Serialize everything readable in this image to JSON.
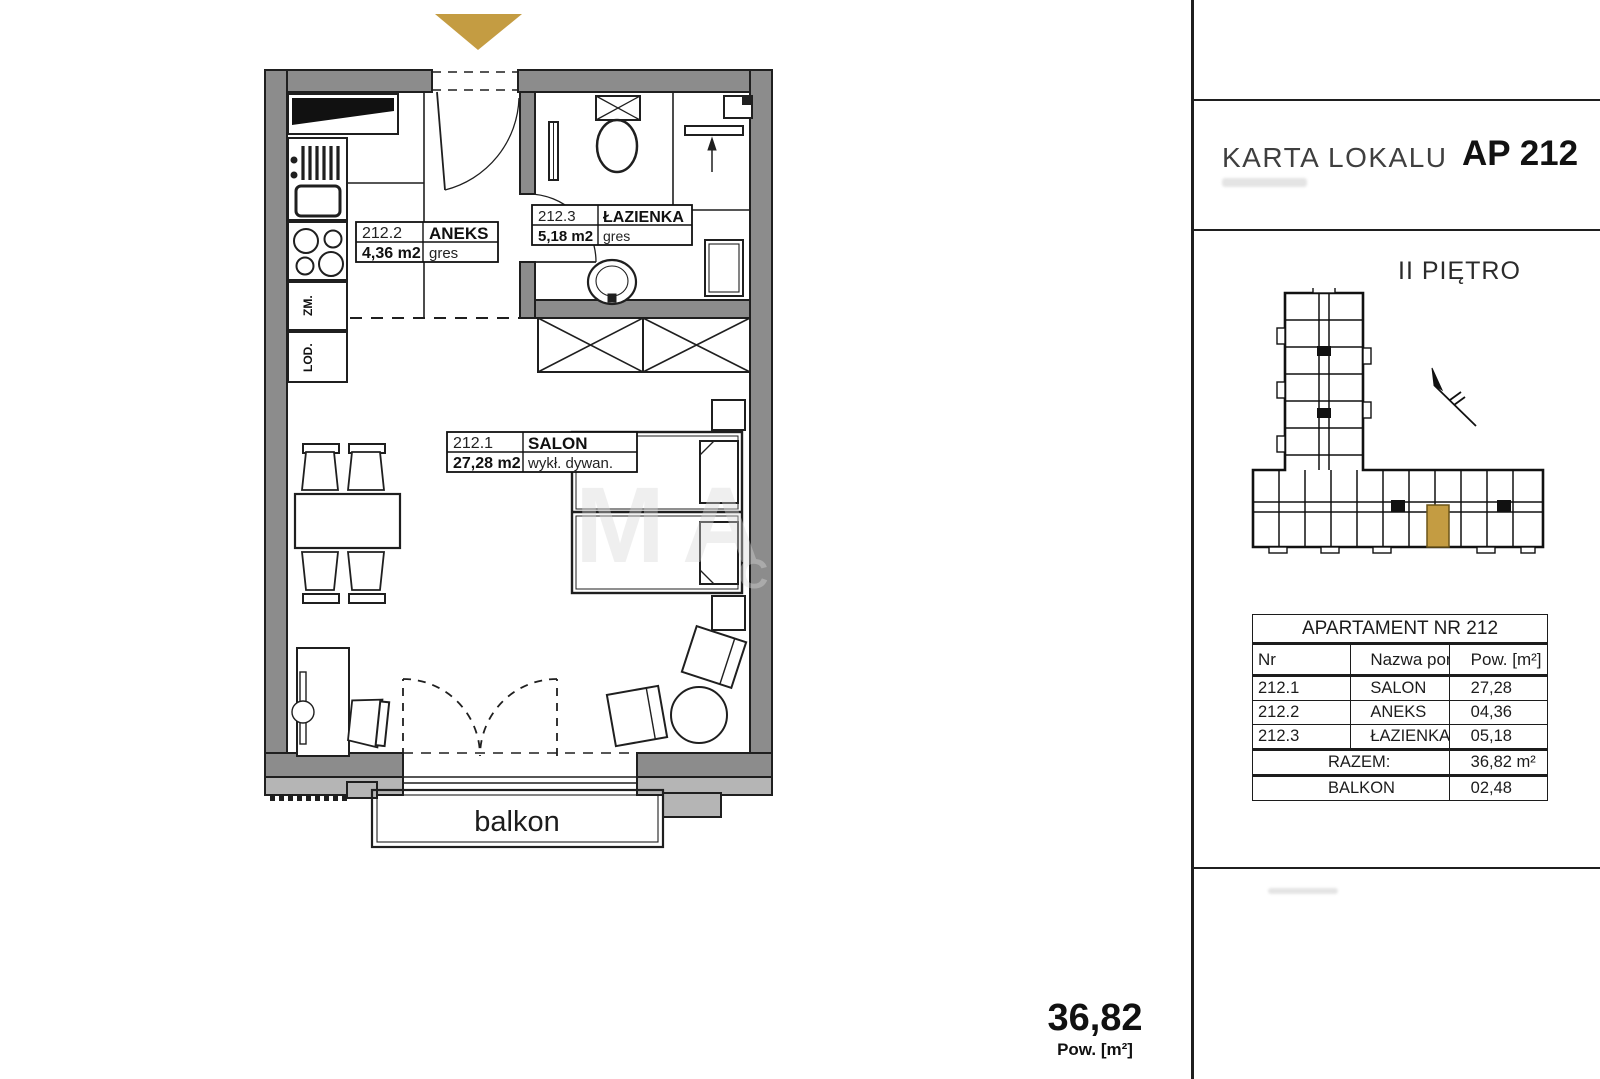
{
  "colors": {
    "accent": "#c49c42",
    "wall": "#8c8c8c",
    "wall_light": "#b5b5b5"
  },
  "header": {
    "title": "KARTA LOKALU",
    "unit": "AP 212"
  },
  "floor_label": "II PIĘTRO",
  "summary": {
    "area": "36,82",
    "unit_label": "Pow. [m²]"
  },
  "plan": {
    "balcony_label": "balkon",
    "kitchen": {
      "dishwasher": "ZM.",
      "fridge": "LOD."
    },
    "rooms": [
      {
        "nr": "212.1",
        "name": "SALON",
        "area": "27,28 m2",
        "floor": "wykł. dywan."
      },
      {
        "nr": "212.2",
        "name": "ANEKS",
        "area": "4,36 m2",
        "floor": "gres"
      },
      {
        "nr": "212.3",
        "name": "ŁAZIENKA",
        "area": "5,18 m2",
        "floor": "gres"
      }
    ]
  },
  "table": {
    "title": "APARTAMENT NR 212",
    "headers": {
      "nr": "Nr",
      "name": "Nazwa pom.",
      "area": "Pow. [m²]"
    },
    "rows": [
      {
        "nr": "212.1",
        "name": "SALON",
        "area": "27,28"
      },
      {
        "nr": "212.2",
        "name": "ANEKS",
        "area": "04,36"
      },
      {
        "nr": "212.3",
        "name": "ŁAZIENKA",
        "area": "05,18"
      }
    ],
    "total_label": "RAZEM:",
    "total_value": "36,82 m²",
    "balcony_label": "BALKON",
    "balcony_value": "02,48"
  }
}
